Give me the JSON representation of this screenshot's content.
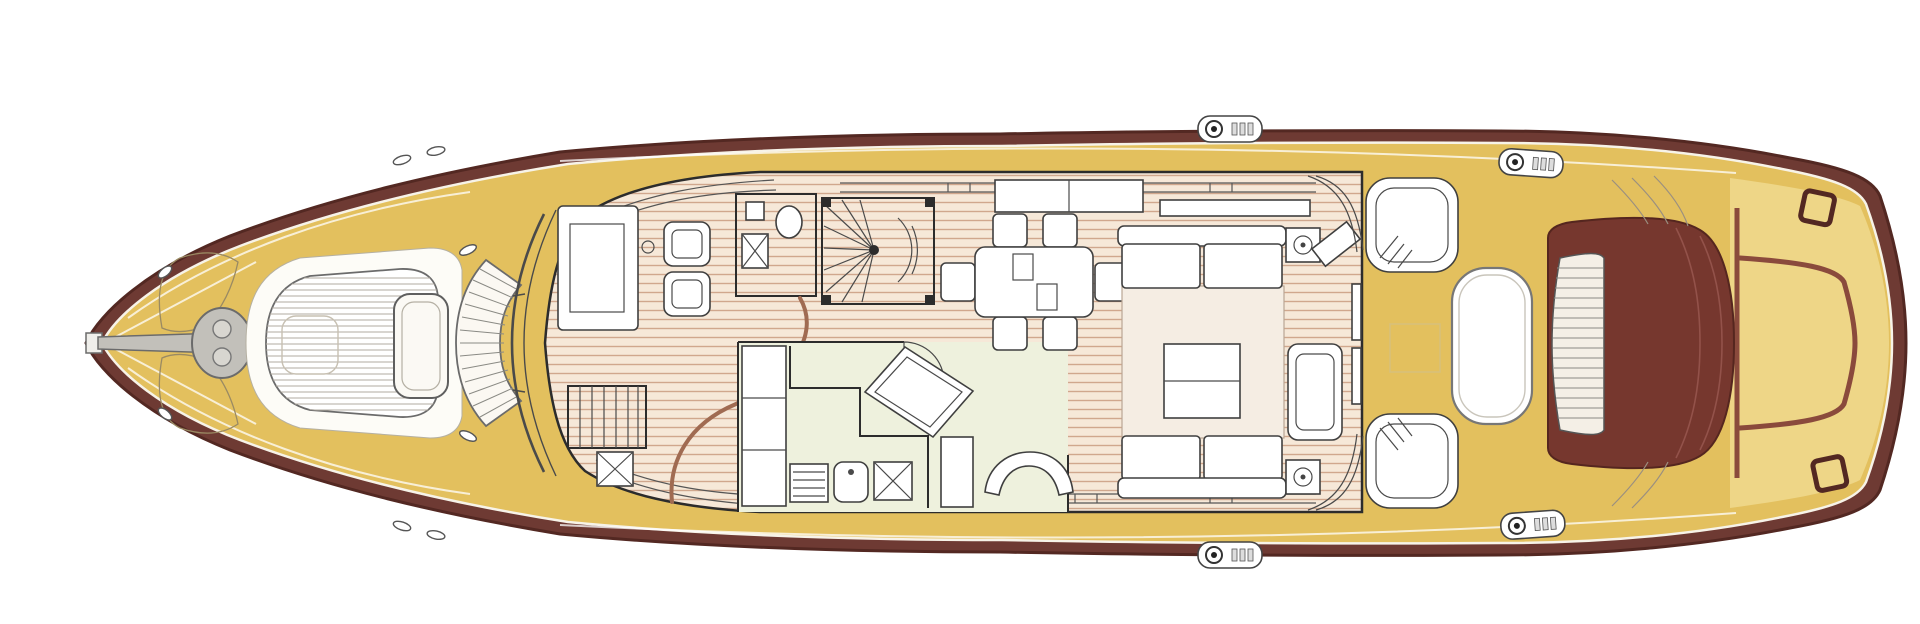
{
  "meta": {
    "type": "yacht-main-deck-floorplan",
    "canvas_width": 1920,
    "canvas_height": 624,
    "orientation": "bow-left-stern-right"
  },
  "colors": {
    "background": "#ffffff",
    "hull_maroon": "#6e3a33",
    "hull_outline": "#532822",
    "deck_yellow": "#e3c05e",
    "gunwale_white": "#f7f3e8",
    "platform_yellow": "#eed687",
    "aft_pad_maroon": "#76372e",
    "aft_pad_outline": "#55261f",
    "trim_brown": "#8a4a3c",
    "rail_brown": "#a06b52",
    "floor_wood_bg": "#f6e8d8",
    "floor_wood_line": "#d0a78d",
    "pale_green": "#eef1dd",
    "rug_cream": "#f5ede3",
    "furniture_white": "#ffffff",
    "furniture_line": "#3f3f3f",
    "wall_line": "#2c2c2c",
    "metal_gray": "#c2c0ba",
    "metal_dark": "#6b6b6b",
    "glass_line": "#4a4a4a",
    "stripe_gray": "#b2aba0",
    "faint_trim": "#d8c07a"
  },
  "parts": {
    "bow": [
      "bow-roller",
      "anchor-shaft",
      "anchor-windlass",
      "bow-hatches",
      "foredeck-cleats"
    ],
    "foredeck": [
      "sunpad",
      "sunpad-backrest",
      "curved-bench",
      "windshield"
    ],
    "cabin": [
      "helm-console",
      "helm-seats",
      "day-head",
      "toilet",
      "sink",
      "spiral-staircase",
      "companionway-stairs",
      "stair-rail",
      "galley",
      "fridge",
      "stove",
      "galley-sink",
      "dishwasher",
      "bar-island",
      "dinette-sofa",
      "dining-table",
      "dining-chairs",
      "sideboard",
      "side-windows"
    ],
    "salon": [
      "sofa-forward",
      "sofa-aft",
      "rug",
      "coffee-table",
      "armchair",
      "speakers",
      "tv-cabinet",
      "aft-door",
      "corner-glazing"
    ],
    "cockpit": [
      "side-bench-port",
      "side-bench-starboard",
      "cockpit-table",
      "aft-sunpad",
      "sunpad-ladder-band",
      "mooring-winches",
      "deck-hatch"
    ],
    "stern": [
      "swim-platform",
      "platform-trim",
      "stern-cleats",
      "canopy-lines"
    ]
  }
}
